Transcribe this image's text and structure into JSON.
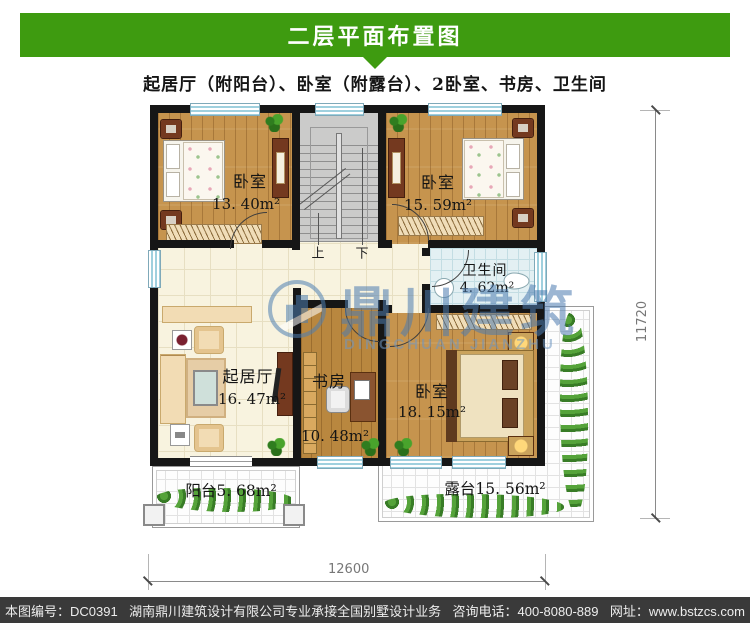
{
  "header": {
    "title": "二层平面布置图",
    "subtitle": "起居厅（附阳台）、卧室（附露台）、2卧室、书房、卫生间"
  },
  "rooms": {
    "bedroom_tl": {
      "name": "卧室",
      "area": "13. 40m²"
    },
    "bedroom_tr": {
      "name": "卧室",
      "area": "15. 59m²"
    },
    "bathroom": {
      "name": "卫生间",
      "area": "4. 62m²"
    },
    "living": {
      "name": "起居厅",
      "area": "16. 47m²"
    },
    "study": {
      "name": "书房",
      "area": "10. 48m²"
    },
    "bedroom_br": {
      "name": "卧室",
      "area": "18. 15m²"
    },
    "balcony": {
      "name": "阳台",
      "area": "5. 68m²"
    },
    "terrace": {
      "name": "露台",
      "area": "15. 56m²"
    }
  },
  "stairs": {
    "up_label": "上",
    "down_label": "下"
  },
  "dimensions": {
    "width_mm": "12600",
    "depth_mm": "11720"
  },
  "watermark": {
    "cn": "鼎川建筑",
    "en": "DINGCHUAN JIANZHU"
  },
  "footer": {
    "drawing_no": "本图编号：DC0391",
    "company": "湖南鼎川建筑设计有限公司专业承接全国别墅设计业务",
    "phone": "咨询电话：400-8080-889",
    "website": "网址：www.bstzcs.com"
  },
  "colors": {
    "header_green": "#3e9b10",
    "footer_bg": "#3a3a3a",
    "watermark_blue": "#4d7cb0",
    "wall_black": "#161616"
  }
}
